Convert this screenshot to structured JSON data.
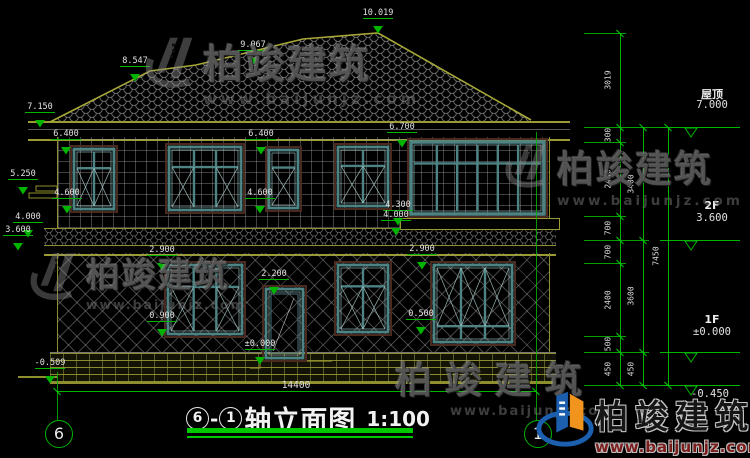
{
  "drawing": {
    "title_axis_start": "6",
    "title_axis_end": "1",
    "title_text": "轴立面图",
    "title_scale": "1:100"
  },
  "watermarks": {
    "brand": "柏竣建筑",
    "site": "www.baijunjz.com"
  },
  "colors": {
    "outline_olive": "#8f8f2e",
    "dim_green": "#00b400",
    "window_teal": "#4e8383",
    "window_teal_light": "#a9cfcf",
    "window_casing": "#4a2a1e",
    "dim_text": "#e2e2e2",
    "logo_blue": "#1b5fae",
    "logo_orange": "#f0941e"
  },
  "elevation_markers": [
    {
      "t": "10.019",
      "x": 378,
      "y": 8
    },
    {
      "t": "9.067",
      "x": 253,
      "y": 40
    },
    {
      "t": "8.547",
      "x": 135,
      "y": 56
    },
    {
      "t": "7.150",
      "x": 40,
      "y": 102
    },
    {
      "t": "6.400",
      "x": 66,
      "y": 129
    },
    {
      "t": "6.400",
      "x": 261,
      "y": 129
    },
    {
      "t": "6.700",
      "x": 402,
      "y": 122
    },
    {
      "t": "5.250",
      "x": 23,
      "y": 169
    },
    {
      "t": "4.600",
      "x": 67,
      "y": 188
    },
    {
      "t": "4.600",
      "x": 260,
      "y": 188
    },
    {
      "t": "4.300",
      "x": 398,
      "y": 200
    },
    {
      "t": "4.000",
      "x": 28,
      "y": 212
    },
    {
      "t": "4.000",
      "x": 396,
      "y": 210
    },
    {
      "t": "3.600",
      "x": 18,
      "y": 225
    },
    {
      "t": "2.900",
      "x": 162,
      "y": 245
    },
    {
      "t": "2.900",
      "x": 422,
      "y": 244
    },
    {
      "t": "2.200",
      "x": 274,
      "y": 269
    },
    {
      "t": "0.900",
      "x": 162,
      "y": 311
    },
    {
      "t": "0.500",
      "x": 421,
      "y": 309
    },
    {
      "t": "±0.000",
      "x": 260,
      "y": 339
    },
    {
      "t": "-0.509",
      "x": 50,
      "y": 358
    }
  ],
  "right_levels": [
    {
      "name": "屋顶",
      "value": "7.000",
      "ty": 86,
      "ly": 127
    },
    {
      "name": "2F",
      "value": "3.600",
      "ty": 199,
      "ly": 240
    },
    {
      "name": "1F",
      "value": "±0.000",
      "ty": 313,
      "ly": 352
    },
    {
      "name": "",
      "value": "-0.450",
      "ty": 388,
      "ly": 385
    }
  ],
  "dim_chains": [
    {
      "x": 620,
      "ticks": [
        33,
        127,
        142,
        216,
        240,
        263,
        336,
        352,
        385
      ],
      "labels": [
        "3019",
        "300",
        "2400",
        "700",
        "700",
        "2400",
        "500",
        "450"
      ]
    },
    {
      "x": 643,
      "ticks": [
        127,
        240,
        352,
        385
      ],
      "labels": [
        "3400",
        "3600",
        "450"
      ]
    },
    {
      "x": 668,
      "ticks": [
        127,
        385
      ],
      "labels": [
        "7450"
      ]
    }
  ],
  "width_dim": {
    "label": "14400",
    "x1": 57,
    "x2": 536,
    "y": 391,
    "label_x": 296
  },
  "axis_bubbles": [
    {
      "label": "6",
      "x": 58,
      "cy": 433
    },
    {
      "label": "1",
      "x": 537,
      "cy": 433
    }
  ],
  "axis_lines": [
    {
      "x": 57,
      "y1": 372,
      "y2": 420
    },
    {
      "x": 536,
      "y1": 132,
      "y2": 420
    }
  ],
  "windows": [
    {
      "name": "window-2f-left",
      "x": 70,
      "y": 145,
      "w": 48,
      "h": 68,
      "type": "2col"
    },
    {
      "name": "window-2f-mid-left",
      "x": 165,
      "y": 143,
      "w": 80,
      "h": 71,
      "type": "3col"
    },
    {
      "name": "window-2f-narrow",
      "x": 265,
      "y": 146,
      "w": 37,
      "h": 66,
      "type": "1col"
    },
    {
      "name": "window-2f-mid-right",
      "x": 334,
      "y": 143,
      "w": 58,
      "h": 67,
      "type": "2col"
    },
    {
      "name": "bay-window-2f",
      "x": 407,
      "y": 138,
      "w": 141,
      "h": 80,
      "type": "bay"
    },
    {
      "name": "window-1f-left",
      "x": 164,
      "y": 261,
      "w": 82,
      "h": 77,
      "type": "3col"
    },
    {
      "name": "entry-door",
      "x": 262,
      "y": 285,
      "w": 45,
      "h": 77,
      "type": "door"
    },
    {
      "name": "window-1f-mid",
      "x": 334,
      "y": 261,
      "w": 58,
      "h": 75,
      "type": "2col"
    },
    {
      "name": "window-1f-right",
      "x": 430,
      "y": 261,
      "w": 86,
      "h": 85,
      "type": "3colX"
    }
  ]
}
